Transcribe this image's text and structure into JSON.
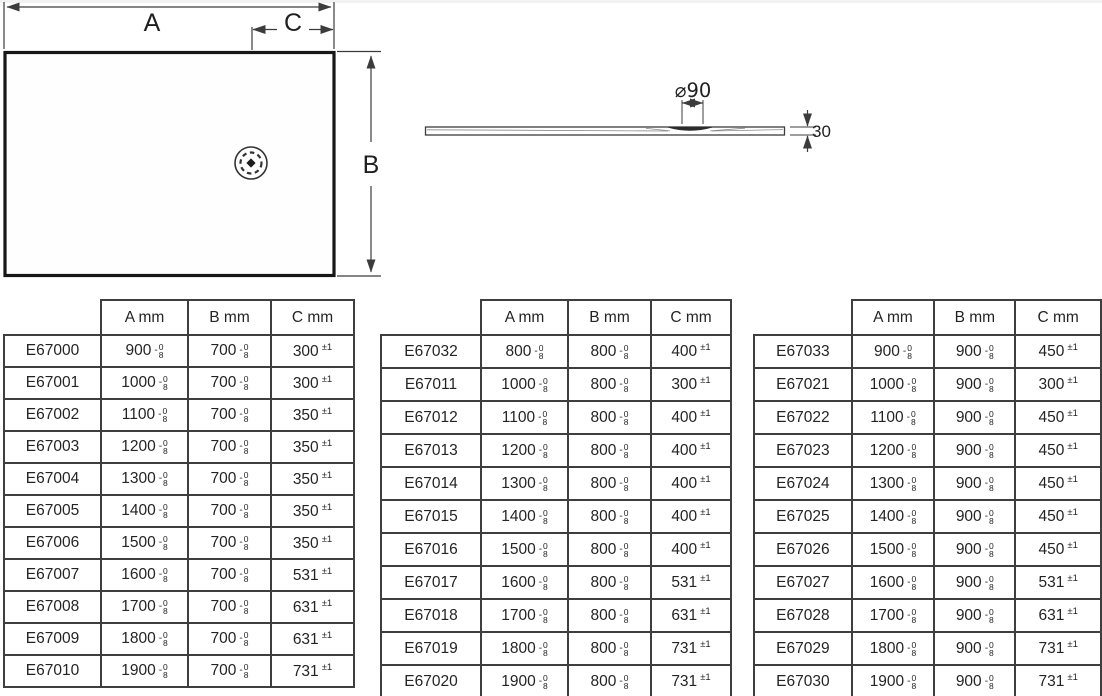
{
  "plan_view": {
    "label_a": "A",
    "label_b": "B",
    "label_c": "C"
  },
  "profile_view": {
    "diameter_label": "⌀90",
    "thickness_label": "30"
  },
  "tables": [
    {
      "headers": [
        "",
        "A mm",
        "B mm",
        "C mm"
      ],
      "ab_tolerance": {
        "sign": "-",
        "upper": "0",
        "lower": "8"
      },
      "c_tolerance": "±1",
      "rows": [
        {
          "code": "E67000",
          "a": "900",
          "b": "700",
          "c": "300"
        },
        {
          "code": "E67001",
          "a": "1000",
          "b": "700",
          "c": "300"
        },
        {
          "code": "E67002",
          "a": "1100",
          "b": "700",
          "c": "350"
        },
        {
          "code": "E67003",
          "a": "1200",
          "b": "700",
          "c": "350"
        },
        {
          "code": "E67004",
          "a": "1300",
          "b": "700",
          "c": "350"
        },
        {
          "code": "E67005",
          "a": "1400",
          "b": "700",
          "c": "350"
        },
        {
          "code": "E67006",
          "a": "1500",
          "b": "700",
          "c": "350"
        },
        {
          "code": "E67007",
          "a": "1600",
          "b": "700",
          "c": "531"
        },
        {
          "code": "E67008",
          "a": "1700",
          "b": "700",
          "c": "631"
        },
        {
          "code": "E67009",
          "a": "1800",
          "b": "700",
          "c": "631"
        },
        {
          "code": "E67010",
          "a": "1900",
          "b": "700",
          "c": "731"
        }
      ]
    },
    {
      "headers": [
        "",
        "A mm",
        "B mm",
        "C mm"
      ],
      "ab_tolerance": {
        "sign": "-",
        "upper": "0",
        "lower": "8"
      },
      "c_tolerance": "±1",
      "rows": [
        {
          "code": "E67032",
          "a": "800",
          "b": "800",
          "c": "400"
        },
        {
          "code": "E67011",
          "a": "1000",
          "b": "800",
          "c": "300"
        },
        {
          "code": "E67012",
          "a": "1100",
          "b": "800",
          "c": "400"
        },
        {
          "code": "E67013",
          "a": "1200",
          "b": "800",
          "c": "400"
        },
        {
          "code": "E67014",
          "a": "1300",
          "b": "800",
          "c": "400"
        },
        {
          "code": "E67015",
          "a": "1400",
          "b": "800",
          "c": "400"
        },
        {
          "code": "E67016",
          "a": "1500",
          "b": "800",
          "c": "400"
        },
        {
          "code": "E67017",
          "a": "1600",
          "b": "800",
          "c": "531"
        },
        {
          "code": "E67018",
          "a": "1700",
          "b": "800",
          "c": "631"
        },
        {
          "code": "E67019",
          "a": "1800",
          "b": "800",
          "c": "731"
        },
        {
          "code": "E67020",
          "a": "1900",
          "b": "800",
          "c": "731"
        }
      ]
    },
    {
      "headers": [
        "",
        "A mm",
        "B mm",
        "C mm"
      ],
      "ab_tolerance": {
        "sign": "-",
        "upper": "0",
        "lower": "8"
      },
      "c_tolerance": "±1",
      "rows": [
        {
          "code": "E67033",
          "a": "900",
          "b": "900",
          "c": "450"
        },
        {
          "code": "E67021",
          "a": "1000",
          "b": "900",
          "c": "300"
        },
        {
          "code": "E67022",
          "a": "1100",
          "b": "900",
          "c": "450"
        },
        {
          "code": "E67023",
          "a": "1200",
          "b": "900",
          "c": "450"
        },
        {
          "code": "E67024",
          "a": "1300",
          "b": "900",
          "c": "450"
        },
        {
          "code": "E67025",
          "a": "1400",
          "b": "900",
          "c": "450"
        },
        {
          "code": "E67026",
          "a": "1500",
          "b": "900",
          "c": "450"
        },
        {
          "code": "E67027",
          "a": "1600",
          "b": "900",
          "c": "531"
        },
        {
          "code": "E67028",
          "a": "1700",
          "b": "900",
          "c": "631"
        },
        {
          "code": "E67029",
          "a": "1800",
          "b": "900",
          "c": "731"
        },
        {
          "code": "E67030",
          "a": "1900",
          "b": "900",
          "c": "731"
        }
      ]
    }
  ]
}
